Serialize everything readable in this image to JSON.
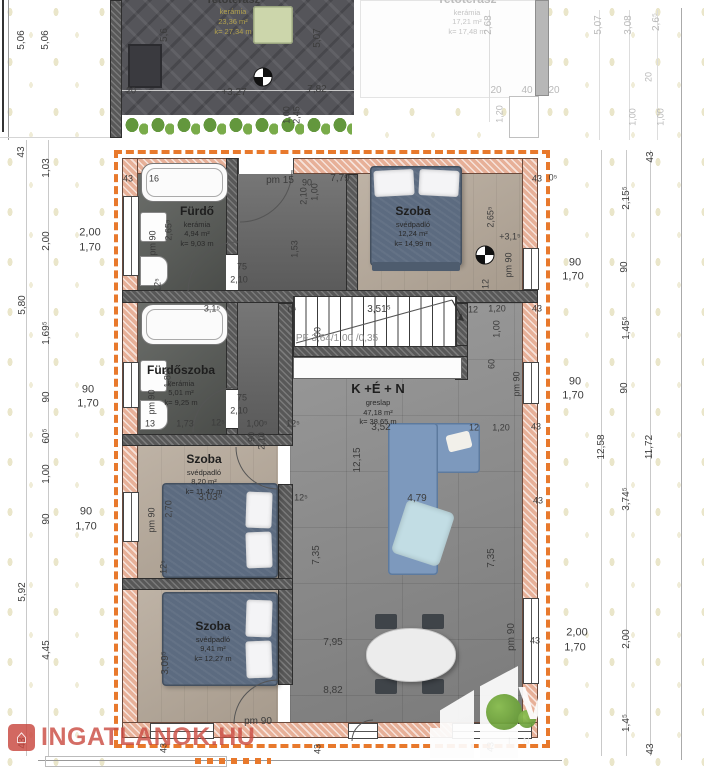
{
  "page": {
    "type": "apartment-floor-plan"
  },
  "colors": {
    "accent_orange": "#e8792c",
    "exterior_wall_hatch": "#e7b098",
    "interior_wall": "#585858",
    "sofa_blue": "#7d99bd",
    "bed_blue": "#5c6b80",
    "terrace_tile": "#55555a",
    "watermark_red": "#c9473f",
    "tree_green": "#6fa33c"
  },
  "rooms": [
    {
      "name": "Tetőterasz",
      "material": "kerámia",
      "area": "23,36 m²",
      "perimeter": "k= 27,34 m"
    },
    {
      "name": "Tetőterasz",
      "material": "kerámia",
      "area": "17,21 m²",
      "perimeter": "k= 17,48 m"
    },
    {
      "name": "Fürdő",
      "material": "kerámia",
      "area": "4,94 m²",
      "perimeter": "k= 9,03 m"
    },
    {
      "name": "Szoba",
      "material": "svédpadló",
      "area": "12,24 m²",
      "perimeter": "k= 14,99 m"
    },
    {
      "name": "Fürdőszoba",
      "material": "kerámia",
      "area": "5,01 m²",
      "perimeter": "k= 9,25 m"
    },
    {
      "name": "K +É + N",
      "material": "greslap",
      "area": "47,18 m²",
      "perimeter": "k= 38,65 m"
    },
    {
      "name": "Szoba",
      "material": "svédpadló",
      "area": "8,20 m²",
      "perimeter": "k= 11,47 m"
    },
    {
      "name": "Szoba",
      "material": "svédpadló",
      "area": "9,41 m²",
      "perimeter": "k= 12,27 m"
    }
  ],
  "watermarks": {
    "brand": "INGATLANOK.HU",
    "brand_icon": "⌂",
    "logo_letter": "V",
    "logo_sub": "I N"
  },
  "dimensions": [
    {
      "t": "5,06",
      "x": 22,
      "y": 40,
      "r": 1,
      "s": 10
    },
    {
      "t": "5,06",
      "x": 46,
      "y": 40,
      "r": 1,
      "s": 10
    },
    {
      "t": "43",
      "x": 22,
      "y": 152,
      "r": 1,
      "s": 10
    },
    {
      "t": "1,03",
      "x": 47,
      "y": 168,
      "r": 1,
      "s": 10
    },
    {
      "t": "2,00",
      "x": 47,
      "y": 241,
      "r": 1,
      "s": 10
    },
    {
      "t": "5,80",
      "x": 23,
      "y": 305,
      "r": 1,
      "s": 10
    },
    {
      "t": "1,69⁵",
      "x": 47,
      "y": 333,
      "r": 1,
      "s": 10
    },
    {
      "t": "90",
      "x": 47,
      "y": 397,
      "r": 1,
      "s": 10
    },
    {
      "t": "60⁵",
      "x": 47,
      "y": 436,
      "r": 1,
      "s": 10
    },
    {
      "t": "1,00",
      "x": 47,
      "y": 474,
      "r": 1,
      "s": 10
    },
    {
      "t": "90",
      "x": 47,
      "y": 519,
      "r": 1,
      "s": 10
    },
    {
      "t": "5,92",
      "x": 23,
      "y": 592,
      "r": 1,
      "s": 10
    },
    {
      "t": "4,45",
      "x": 47,
      "y": 650,
      "r": 1,
      "s": 10
    },
    {
      "t": "43",
      "x": 23,
      "y": 743,
      "r": 1,
      "s": 10
    },
    {
      "t": "2,00",
      "x": 90,
      "y": 233,
      "s": 11
    },
    {
      "t": "1,70",
      "x": 90,
      "y": 248,
      "s": 11
    },
    {
      "t": "90",
      "x": 88,
      "y": 390,
      "s": 11
    },
    {
      "t": "1,70",
      "x": 88,
      "y": 404,
      "s": 11
    },
    {
      "t": "90",
      "x": 86,
      "y": 512,
      "s": 11
    },
    {
      "t": "1,70",
      "x": 86,
      "y": 527,
      "s": 11
    },
    {
      "t": "5,6",
      "x": 165,
      "y": 35,
      "r": 1,
      "s": 10
    },
    {
      "t": "5,07",
      "x": 318,
      "y": 38,
      "r": 1,
      "s": 10
    },
    {
      "t": "20",
      "x": 131,
      "y": 91
    },
    {
      "t": "+3,27",
      "x": 234,
      "y": 93,
      "s": 10
    },
    {
      "t": "7,82",
      "x": 317,
      "y": 90,
      "s": 10
    },
    {
      "t": "1,00",
      "x": 287,
      "y": 115,
      "r": 1
    },
    {
      "t": "2,45",
      "x": 297,
      "y": 115,
      "r": 1
    },
    {
      "t": "2,68",
      "x": 489,
      "y": 25,
      "r": 1,
      "c": "f",
      "s": 10
    },
    {
      "t": "5,07",
      "x": 599,
      "y": 25,
      "r": 1,
      "c": "f",
      "s": 10
    },
    {
      "t": "3,08",
      "x": 629,
      "y": 25,
      "r": 1,
      "c": "f",
      "s": 10
    },
    {
      "t": "2,6⁵",
      "x": 657,
      "y": 22,
      "r": 1,
      "c": "f",
      "s": 10
    },
    {
      "t": "20",
      "x": 496,
      "y": 91,
      "c": "f",
      "s": 10
    },
    {
      "t": "40",
      "x": 527,
      "y": 91,
      "c": "f",
      "s": 10
    },
    {
      "t": "20",
      "x": 554,
      "y": 91,
      "c": "f",
      "s": 10
    },
    {
      "t": "1,20",
      "x": 500,
      "y": 114,
      "r": 1,
      "c": "f"
    },
    {
      "t": "20",
      "x": 649,
      "y": 77,
      "r": 1,
      "c": "f"
    },
    {
      "t": "1,00",
      "x": 633,
      "y": 117,
      "r": 1,
      "c": "f"
    },
    {
      "t": "1,00",
      "x": 661,
      "y": 117,
      "r": 1,
      "c": "f"
    },
    {
      "t": "43",
      "x": 651,
      "y": 157,
      "r": 1,
      "s": 10
    },
    {
      "t": "2,15⁵",
      "x": 627,
      "y": 198,
      "r": 1,
      "s": 10
    },
    {
      "t": "90",
      "x": 625,
      "y": 267,
      "r": 1,
      "s": 10
    },
    {
      "t": "1,45⁵",
      "x": 627,
      "y": 328,
      "r": 1,
      "s": 10
    },
    {
      "t": "90",
      "x": 625,
      "y": 388,
      "r": 1,
      "s": 10
    },
    {
      "t": "12,58",
      "x": 602,
      "y": 447,
      "r": 1,
      "s": 10
    },
    {
      "t": "11,72",
      "x": 650,
      "y": 447,
      "r": 1,
      "s": 10
    },
    {
      "t": "3,74⁵",
      "x": 627,
      "y": 499,
      "r": 1,
      "s": 10
    },
    {
      "t": "2,00",
      "x": 627,
      "y": 639,
      "r": 1,
      "s": 10
    },
    {
      "t": "1,4⁵",
      "x": 627,
      "y": 723,
      "r": 1,
      "s": 10
    },
    {
      "t": "43",
      "x": 651,
      "y": 749,
      "r": 1,
      "s": 10
    },
    {
      "t": "90",
      "x": 575,
      "y": 263,
      "s": 11
    },
    {
      "t": "1,70",
      "x": 573,
      "y": 277,
      "s": 11
    },
    {
      "t": "90",
      "x": 575,
      "y": 382,
      "s": 11
    },
    {
      "t": "1,70",
      "x": 573,
      "y": 396,
      "s": 11
    },
    {
      "t": "2,00",
      "x": 577,
      "y": 633,
      "s": 11
    },
    {
      "t": "1,70",
      "x": 575,
      "y": 648,
      "s": 11
    },
    {
      "t": "43",
      "x": 128,
      "y": 179
    },
    {
      "t": "16",
      "x": 154,
      "y": 179
    },
    {
      "t": "pm 15",
      "x": 280,
      "y": 181,
      "s": 10
    },
    {
      "t": "90",
      "x": 307,
      "y": 183
    },
    {
      "t": "7,79",
      "x": 340,
      "y": 179,
      "s": 10
    },
    {
      "t": "1,00",
      "x": 315,
      "y": 192,
      "r": 1
    },
    {
      "t": "2,10",
      "x": 304,
      "y": 196,
      "r": 1
    },
    {
      "t": "43",
      "x": 537,
      "y": 179
    },
    {
      "t": "0⁵",
      "x": 553,
      "y": 178
    },
    {
      "t": "1,53",
      "x": 295,
      "y": 249,
      "r": 1
    },
    {
      "t": "2,65⁵",
      "x": 169,
      "y": 230,
      "r": 1
    },
    {
      "t": "pm 90",
      "x": 153,
      "y": 243,
      "r": 1
    },
    {
      "t": "75",
      "x": 242,
      "y": 267
    },
    {
      "t": "2,10",
      "x": 239,
      "y": 280
    },
    {
      "t": "12⁵",
      "x": 158,
      "y": 285,
      "r": 1
    },
    {
      "t": "2,65⁵",
      "x": 491,
      "y": 217,
      "r": 1
    },
    {
      "t": "+3,1⁵",
      "x": 510,
      "y": 237
    },
    {
      "t": "pm 90",
      "x": 509,
      "y": 265,
      "r": 1
    },
    {
      "t": "12",
      "x": 486,
      "y": 284,
      "r": 1
    },
    {
      "t": "3,1⁵",
      "x": 212,
      "y": 309
    },
    {
      "t": "0⁵",
      "x": 292,
      "y": 310
    },
    {
      "t": "3,51⁵",
      "x": 379,
      "y": 310,
      "s": 10
    },
    {
      "t": "12",
      "x": 473,
      "y": 310
    },
    {
      "t": "1,20",
      "x": 497,
      "y": 309
    },
    {
      "t": "43",
      "x": 537,
      "y": 309
    },
    {
      "t": "90",
      "x": 318,
      "y": 332,
      "r": 1
    },
    {
      "t": "1,00",
      "x": 497,
      "y": 329,
      "r": 1
    },
    {
      "t": "60",
      "x": 492,
      "y": 364,
      "r": 1
    },
    {
      "t": "pm 90",
      "x": 517,
      "y": 384,
      "r": 1
    },
    {
      "t": "PF 3,64/1,00 /0,35",
      "x": 337,
      "y": 339,
      "c": "g",
      "s": 10
    },
    {
      "t": "1,89⁵",
      "x": 168,
      "y": 377,
      "r": 1
    },
    {
      "t": "pm 90",
      "x": 152,
      "y": 402,
      "r": 1
    },
    {
      "t": "75",
      "x": 242,
      "y": 398
    },
    {
      "t": "2,10",
      "x": 239,
      "y": 411
    },
    {
      "t": "13",
      "x": 150,
      "y": 424
    },
    {
      "t": "1,73",
      "x": 185,
      "y": 424
    },
    {
      "t": "12⁵",
      "x": 218,
      "y": 423
    },
    {
      "t": "1,00⁵",
      "x": 257,
      "y": 424
    },
    {
      "t": "12⁵",
      "x": 293,
      "y": 424
    },
    {
      "t": "90",
      "x": 252,
      "y": 437,
      "r": 1
    },
    {
      "t": "2,10",
      "x": 262,
      "y": 441,
      "r": 1
    },
    {
      "t": "3,52",
      "x": 381,
      "y": 428,
      "s": 10
    },
    {
      "t": "12",
      "x": 474,
      "y": 428
    },
    {
      "t": "1,20",
      "x": 501,
      "y": 428
    },
    {
      "t": "43",
      "x": 536,
      "y": 427
    },
    {
      "t": "12,15",
      "x": 358,
      "y": 460,
      "r": 1,
      "s": 10
    },
    {
      "t": "4,79",
      "x": 417,
      "y": 499,
      "s": 10
    },
    {
      "t": "7,35",
      "x": 492,
      "y": 558,
      "r": 1,
      "s": 10
    },
    {
      "t": "7,35",
      "x": 317,
      "y": 555,
      "r": 1,
      "s": 10
    },
    {
      "t": "3,03⁵",
      "x": 210,
      "y": 498,
      "s": 10
    },
    {
      "t": "2,70",
      "x": 169,
      "y": 509,
      "r": 1
    },
    {
      "t": "pm 90",
      "x": 152,
      "y": 520,
      "r": 1
    },
    {
      "t": "12⁵",
      "x": 164,
      "y": 567,
      "r": 1
    },
    {
      "t": "12⁵",
      "x": 301,
      "y": 498
    },
    {
      "t": "3,09⁵",
      "x": 166,
      "y": 663,
      "r": 1,
      "s": 10
    },
    {
      "t": "pm 90",
      "x": 258,
      "y": 722,
      "s": 10
    },
    {
      "t": "7,95",
      "x": 333,
      "y": 643,
      "s": 10
    },
    {
      "t": "8,82",
      "x": 333,
      "y": 691,
      "s": 10
    },
    {
      "t": "pm 90",
      "x": 512,
      "y": 637,
      "r": 1,
      "s": 10
    },
    {
      "t": "43",
      "x": 535,
      "y": 641
    },
    {
      "t": "43",
      "x": 538,
      "y": 501
    },
    {
      "t": "43",
      "x": 164,
      "y": 748,
      "r": 1
    },
    {
      "t": "43",
      "x": 318,
      "y": 749,
      "r": 1
    },
    {
      "t": "43",
      "x": 491,
      "y": 747,
      "r": 1
    }
  ]
}
